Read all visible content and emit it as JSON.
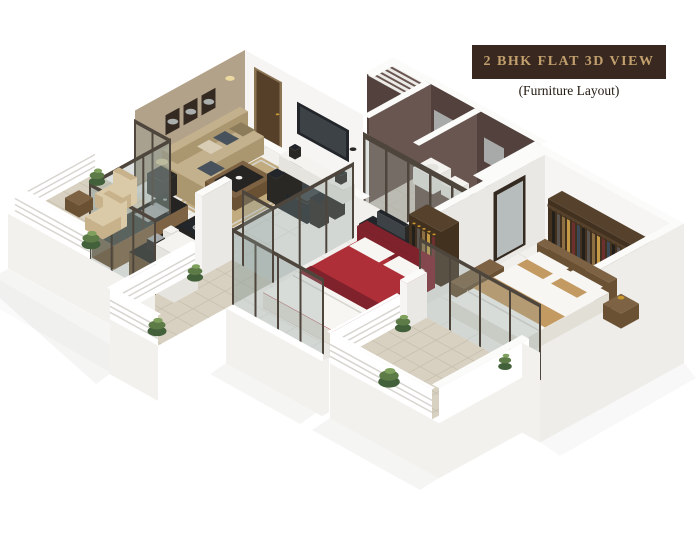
{
  "banner": {
    "title": "2 BHK FLAT 3D VIEW",
    "subtitle": "(Furniture Layout)"
  },
  "colors": {
    "page_bg": "#ffffff",
    "banner_bg": "#38281f",
    "banner_text": "#c2a06e",
    "subtitle_text": "#221910",
    "accent_wall": "#b3a28a",
    "wall_light": "#f6f5f3",
    "wall_side": "#eae8e4",
    "wall_top": "#fbfbfa",
    "wall_outer": "#efedea",
    "floor_light": "#f1f0ed",
    "floor_line": "#e1dfd9",
    "balcony_floor": "#d8d1c1",
    "tile_dark": "#52413c",
    "tile_dark2": "#6a5650",
    "louver": "#eceae6",
    "door_brown": "#57402a",
    "tv_dark": "#22262a",
    "counter_top": "#262422",
    "cabinet_wood": "#6b5133",
    "sofa_beige": "#c3b08c",
    "rug_tan": "#c2ab7e",
    "bed_red": "#ae2f37",
    "bed_tan": "#c49a63",
    "wardrobe_wood": "#43311f",
    "mirror_glass": "#b7bdbc",
    "glass_pane": "#90a09c",
    "glass_frame": "#4e463c",
    "railing_white": "#ffffff",
    "plant_green": "#5d7b47",
    "wicker_tan": "#c8b28b",
    "shadow_gray": "#9a9a96"
  }
}
